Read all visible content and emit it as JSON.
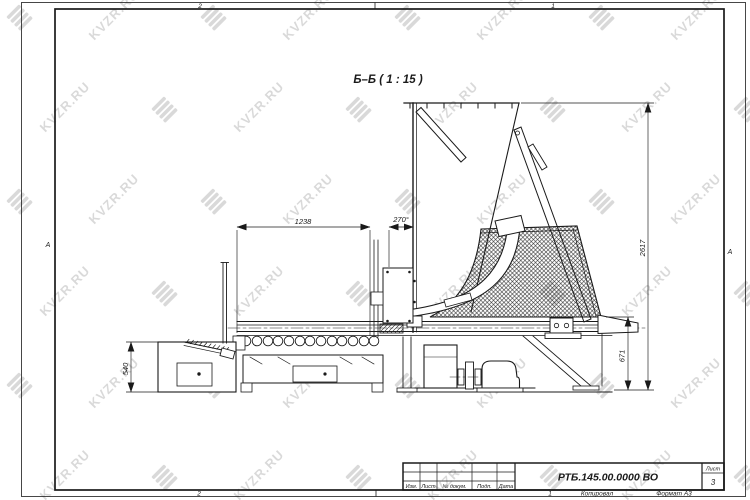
{
  "drawing": {
    "view_label": "Б–Б ( 1 : 15 )",
    "dimensions": {
      "conveyor_length": "1238",
      "chute_angle": "270°",
      "hopper_height": "2617",
      "discharge_height": "671",
      "table_height": "540"
    },
    "zones": {
      "top_left": "2",
      "top_right": "1",
      "bottom_left": "2",
      "bottom_right": "1",
      "left": "А",
      "right": "А"
    }
  },
  "title_block": {
    "doc_number": "РТБ.145.00.0000 ВО",
    "columns": [
      "Изм.",
      "Лист",
      "№ докум.",
      "Подп.",
      "Дата"
    ],
    "sheet_label": "Лист",
    "sheet_number": "3",
    "footer": {
      "copied_label": "Копировал",
      "format_label": "Формат А3"
    }
  },
  "watermark": {
    "text": "KVZR.RU"
  }
}
